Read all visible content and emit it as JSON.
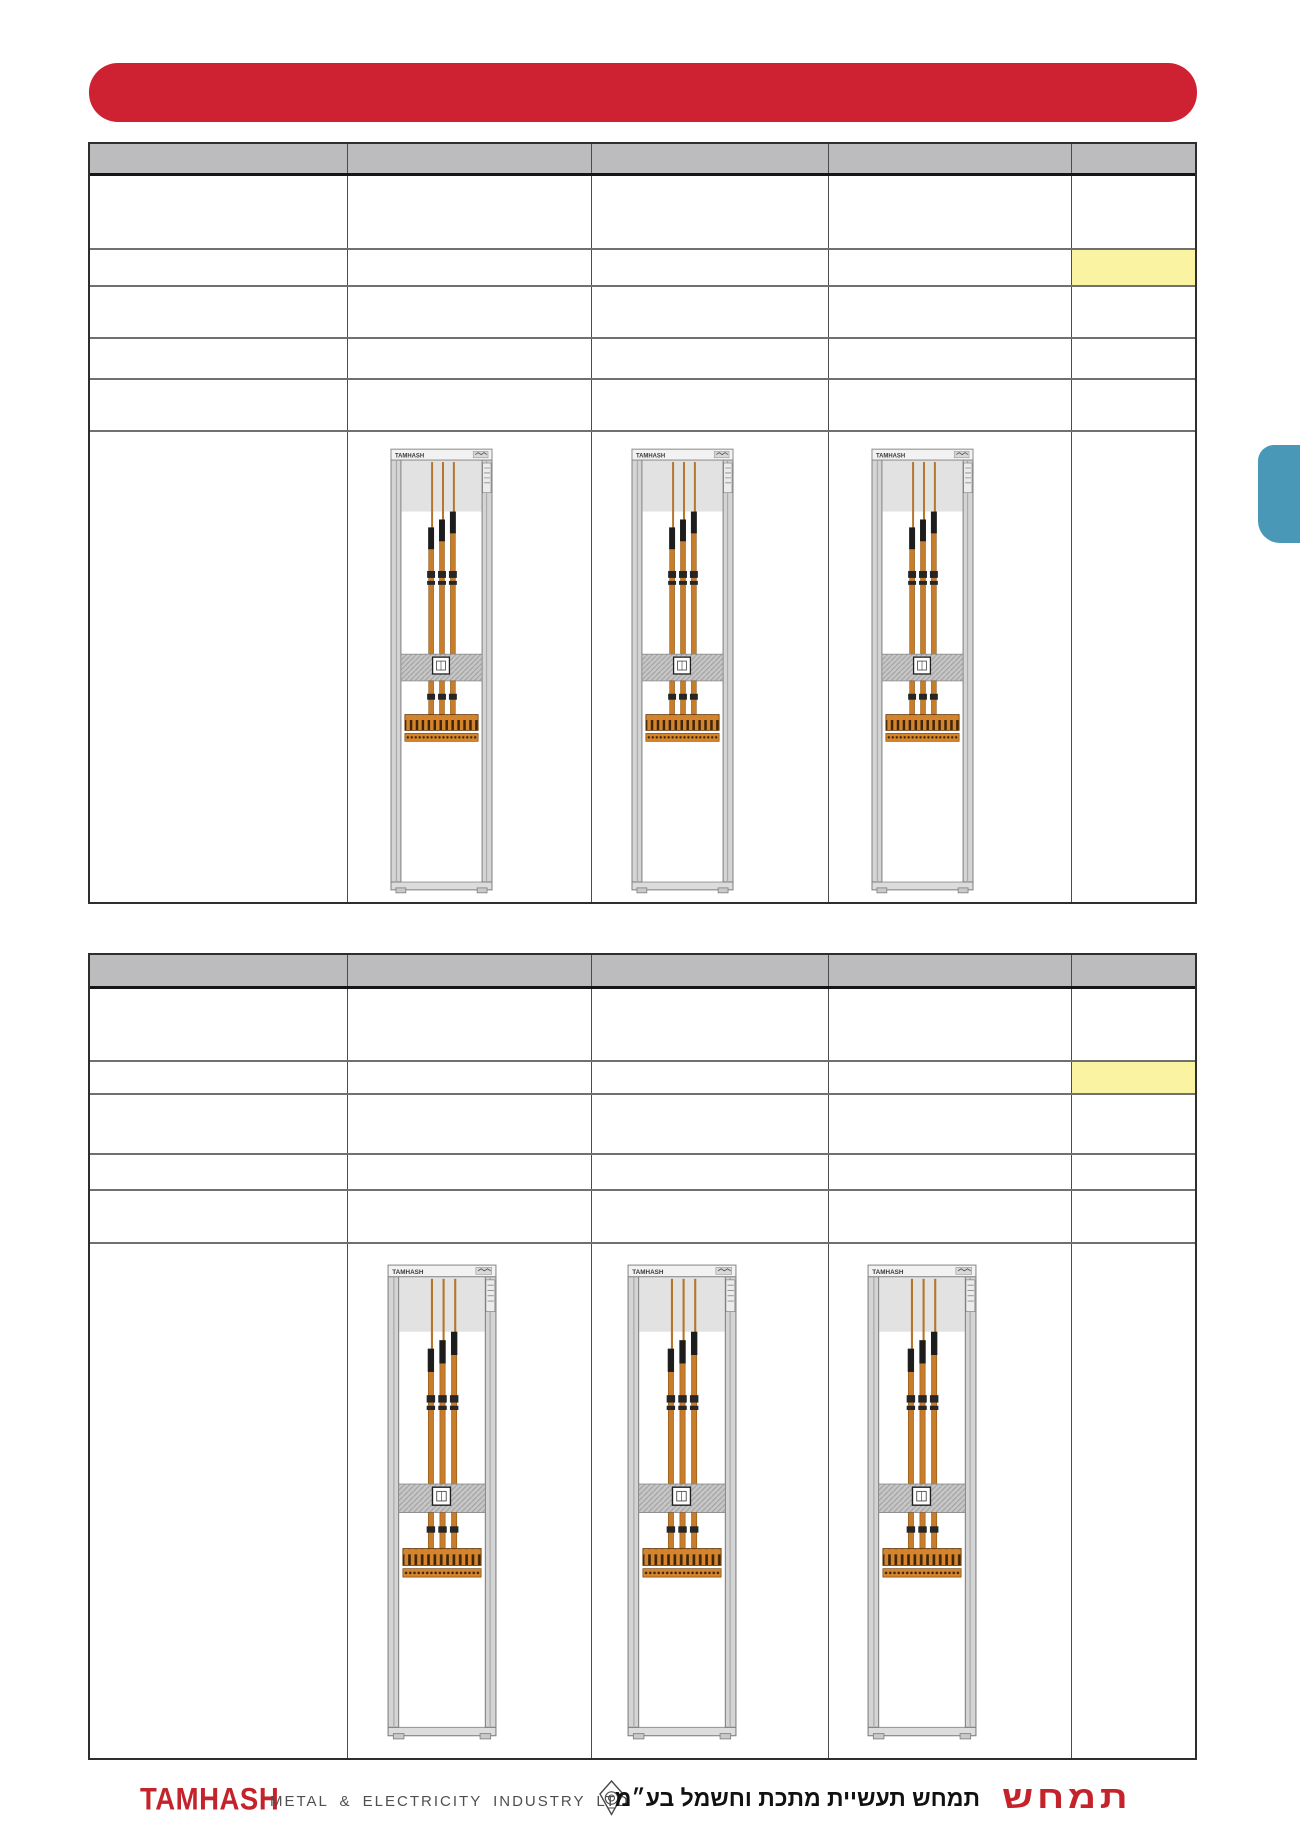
{
  "banner": {
    "label": "",
    "color": "#ce2132"
  },
  "side_tab": {
    "color": "#4a98b8"
  },
  "tables": [
    {
      "header_labels": [
        "",
        "",
        "",
        "",
        ""
      ],
      "rows": [
        [
          "",
          "",
          "",
          "",
          ""
        ],
        [
          "",
          "",
          "",
          "",
          ""
        ],
        [
          "",
          "",
          "",
          "",
          ""
        ],
        [
          "",
          "",
          "",
          "",
          ""
        ],
        [
          "",
          "",
          "",
          "",
          ""
        ]
      ],
      "highlighted_cell": {
        "row": 2,
        "column": 5,
        "color": "#faf4a2"
      },
      "cabinet_images": 3
    },
    {
      "header_labels": [
        "",
        "",
        "",
        "",
        ""
      ],
      "rows": [
        [
          "",
          "",
          "",
          "",
          ""
        ],
        [
          "",
          "",
          "",
          "",
          ""
        ],
        [
          "",
          "",
          "",
          "",
          ""
        ],
        [
          "",
          "",
          "",
          "",
          ""
        ],
        [
          "",
          "",
          "",
          "",
          ""
        ]
      ],
      "highlighted_cell": {
        "row": 2,
        "column": 5,
        "color": "#faf4a2"
      },
      "cabinet_images": 3
    }
  ],
  "cabinet": {
    "brand_label": "TAMHASH",
    "busbar_color": "#c87d2b"
  },
  "footer": {
    "logo_en": "TAMHASH",
    "tagline_en": "METAL & ELECTRICITY INDUSTRY LTD",
    "tagline_he": "תמחש תעשיית מתכת וחשמל בע״מ",
    "logo_he": "תמחש"
  }
}
